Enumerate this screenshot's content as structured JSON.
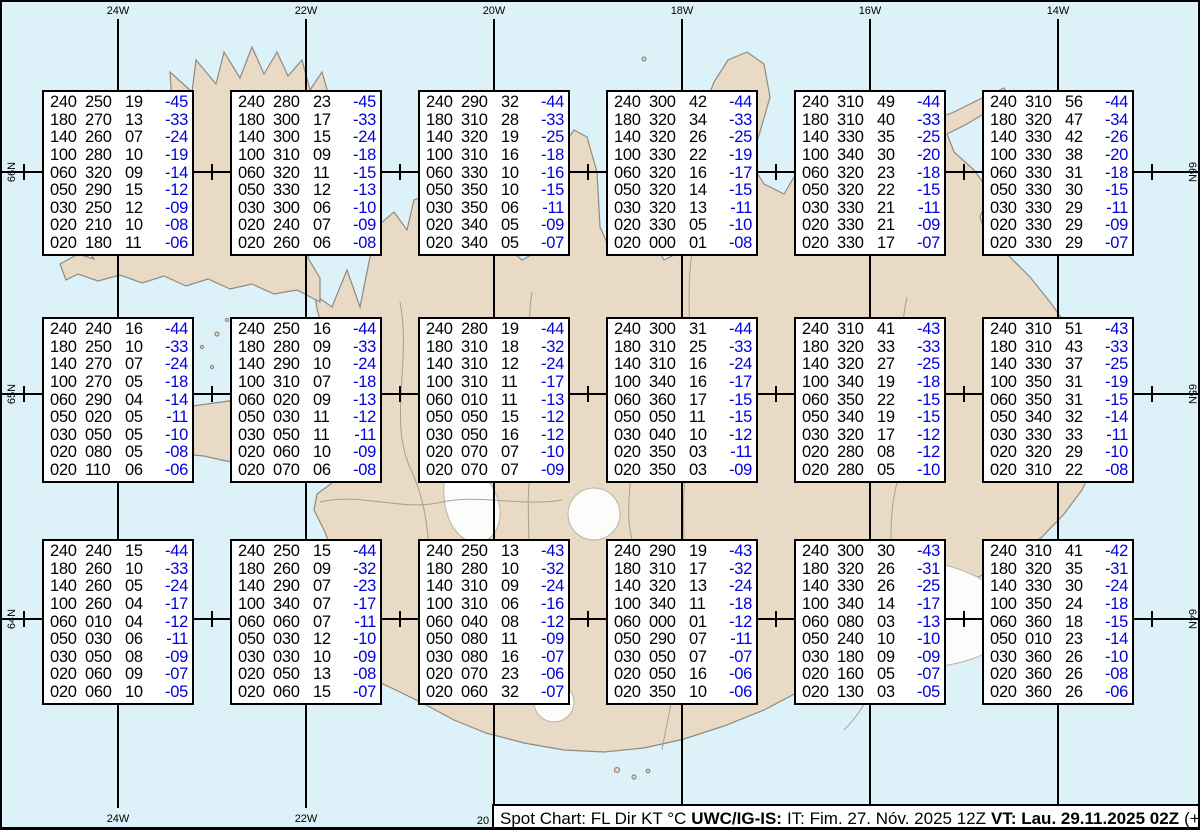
{
  "chart_data": {
    "type": "table",
    "title": "Spot Chart: FL Dir KT °C",
    "columns": [
      "FL",
      "Dir",
      "KT",
      "TempC"
    ],
    "grid_longitudes": [
      "24W",
      "22W",
      "20W",
      "18W",
      "16W",
      "14W"
    ],
    "grid_latitudes": [
      "66N",
      "65N",
      "64N"
    ],
    "points": [
      {
        "lat": "66N",
        "lon": "24W",
        "rows": [
          [
            "240",
            "250",
            "19",
            "-45"
          ],
          [
            "180",
            "270",
            "13",
            "-33"
          ],
          [
            "140",
            "260",
            "07",
            "-24"
          ],
          [
            "100",
            "280",
            "10",
            "-19"
          ],
          [
            "060",
            "320",
            "09",
            "-14"
          ],
          [
            "050",
            "290",
            "15",
            "-12"
          ],
          [
            "030",
            "250",
            "12",
            "-09"
          ],
          [
            "020",
            "210",
            "10",
            "-08"
          ],
          [
            "020",
            "180",
            "11",
            "-06"
          ]
        ]
      },
      {
        "lat": "66N",
        "lon": "22W",
        "rows": [
          [
            "240",
            "280",
            "23",
            "-45"
          ],
          [
            "180",
            "300",
            "17",
            "-33"
          ],
          [
            "140",
            "300",
            "15",
            "-24"
          ],
          [
            "100",
            "310",
            "09",
            "-18"
          ],
          [
            "060",
            "320",
            "11",
            "-15"
          ],
          [
            "050",
            "330",
            "12",
            "-13"
          ],
          [
            "030",
            "300",
            "06",
            "-10"
          ],
          [
            "020",
            "240",
            "07",
            "-09"
          ],
          [
            "020",
            "260",
            "06",
            "-08"
          ]
        ]
      },
      {
        "lat": "66N",
        "lon": "20W",
        "rows": [
          [
            "240",
            "290",
            "32",
            "-44"
          ],
          [
            "180",
            "310",
            "28",
            "-33"
          ],
          [
            "140",
            "320",
            "19",
            "-25"
          ],
          [
            "100",
            "310",
            "16",
            "-18"
          ],
          [
            "060",
            "330",
            "10",
            "-16"
          ],
          [
            "050",
            "350",
            "10",
            "-15"
          ],
          [
            "030",
            "350",
            "06",
            "-11"
          ],
          [
            "020",
            "340",
            "05",
            "-09"
          ],
          [
            "020",
            "340",
            "05",
            "-07"
          ]
        ]
      },
      {
        "lat": "66N",
        "lon": "18W",
        "rows": [
          [
            "240",
            "300",
            "42",
            "-44"
          ],
          [
            "180",
            "320",
            "34",
            "-33"
          ],
          [
            "140",
            "320",
            "26",
            "-25"
          ],
          [
            "100",
            "330",
            "22",
            "-19"
          ],
          [
            "060",
            "320",
            "16",
            "-17"
          ],
          [
            "050",
            "320",
            "14",
            "-15"
          ],
          [
            "030",
            "320",
            "13",
            "-11"
          ],
          [
            "020",
            "330",
            "05",
            "-10"
          ],
          [
            "020",
            "000",
            "01",
            "-08"
          ]
        ]
      },
      {
        "lat": "66N",
        "lon": "16W",
        "rows": [
          [
            "240",
            "310",
            "49",
            "-44"
          ],
          [
            "180",
            "310",
            "40",
            "-33"
          ],
          [
            "140",
            "330",
            "35",
            "-25"
          ],
          [
            "100",
            "340",
            "30",
            "-20"
          ],
          [
            "060",
            "320",
            "23",
            "-18"
          ],
          [
            "050",
            "320",
            "22",
            "-15"
          ],
          [
            "030",
            "330",
            "21",
            "-11"
          ],
          [
            "020",
            "330",
            "21",
            "-09"
          ],
          [
            "020",
            "330",
            "17",
            "-07"
          ]
        ]
      },
      {
        "lat": "66N",
        "lon": "14W",
        "rows": [
          [
            "240",
            "310",
            "56",
            "-44"
          ],
          [
            "180",
            "320",
            "47",
            "-34"
          ],
          [
            "140",
            "330",
            "42",
            "-26"
          ],
          [
            "100",
            "330",
            "38",
            "-20"
          ],
          [
            "060",
            "330",
            "31",
            "-18"
          ],
          [
            "050",
            "330",
            "30",
            "-15"
          ],
          [
            "030",
            "330",
            "29",
            "-11"
          ],
          [
            "020",
            "330",
            "29",
            "-09"
          ],
          [
            "020",
            "330",
            "29",
            "-07"
          ]
        ]
      },
      {
        "lat": "65N",
        "lon": "24W",
        "rows": [
          [
            "240",
            "240",
            "16",
            "-44"
          ],
          [
            "180",
            "250",
            "10",
            "-33"
          ],
          [
            "140",
            "270",
            "07",
            "-24"
          ],
          [
            "100",
            "270",
            "05",
            "-18"
          ],
          [
            "060",
            "290",
            "04",
            "-14"
          ],
          [
            "050",
            "020",
            "05",
            "-11"
          ],
          [
            "030",
            "050",
            "05",
            "-10"
          ],
          [
            "020",
            "080",
            "05",
            "-08"
          ],
          [
            "020",
            "110",
            "06",
            "-06"
          ]
        ]
      },
      {
        "lat": "65N",
        "lon": "22W",
        "rows": [
          [
            "240",
            "250",
            "16",
            "-44"
          ],
          [
            "180",
            "280",
            "09",
            "-33"
          ],
          [
            "140",
            "290",
            "10",
            "-24"
          ],
          [
            "100",
            "310",
            "07",
            "-18"
          ],
          [
            "060",
            "020",
            "09",
            "-13"
          ],
          [
            "050",
            "030",
            "11",
            "-12"
          ],
          [
            "030",
            "050",
            "11",
            "-11"
          ],
          [
            "020",
            "060",
            "10",
            "-09"
          ],
          [
            "020",
            "070",
            "06",
            "-08"
          ]
        ]
      },
      {
        "lat": "65N",
        "lon": "20W",
        "rows": [
          [
            "240",
            "280",
            "19",
            "-44"
          ],
          [
            "180",
            "310",
            "18",
            "-32"
          ],
          [
            "140",
            "310",
            "12",
            "-24"
          ],
          [
            "100",
            "310",
            "11",
            "-17"
          ],
          [
            "060",
            "010",
            "11",
            "-13"
          ],
          [
            "050",
            "050",
            "15",
            "-12"
          ],
          [
            "030",
            "050",
            "16",
            "-12"
          ],
          [
            "020",
            "070",
            "07",
            "-10"
          ],
          [
            "020",
            "070",
            "07",
            "-09"
          ]
        ]
      },
      {
        "lat": "65N",
        "lon": "18W",
        "rows": [
          [
            "240",
            "300",
            "31",
            "-44"
          ],
          [
            "180",
            "310",
            "25",
            "-33"
          ],
          [
            "140",
            "310",
            "16",
            "-24"
          ],
          [
            "100",
            "340",
            "16",
            "-17"
          ],
          [
            "060",
            "360",
            "17",
            "-15"
          ],
          [
            "050",
            "050",
            "11",
            "-15"
          ],
          [
            "030",
            "040",
            "10",
            "-12"
          ],
          [
            "020",
            "350",
            "03",
            "-11"
          ],
          [
            "020",
            "350",
            "03",
            "-09"
          ]
        ]
      },
      {
        "lat": "65N",
        "lon": "16W",
        "rows": [
          [
            "240",
            "310",
            "41",
            "-43"
          ],
          [
            "180",
            "320",
            "33",
            "-33"
          ],
          [
            "140",
            "320",
            "27",
            "-25"
          ],
          [
            "100",
            "340",
            "19",
            "-18"
          ],
          [
            "060",
            "350",
            "22",
            "-15"
          ],
          [
            "050",
            "340",
            "19",
            "-15"
          ],
          [
            "030",
            "320",
            "17",
            "-12"
          ],
          [
            "020",
            "280",
            "08",
            "-12"
          ],
          [
            "020",
            "280",
            "05",
            "-10"
          ]
        ]
      },
      {
        "lat": "65N",
        "lon": "14W",
        "rows": [
          [
            "240",
            "310",
            "51",
            "-43"
          ],
          [
            "180",
            "310",
            "43",
            "-33"
          ],
          [
            "140",
            "330",
            "37",
            "-25"
          ],
          [
            "100",
            "350",
            "31",
            "-19"
          ],
          [
            "060",
            "350",
            "31",
            "-15"
          ],
          [
            "050",
            "340",
            "32",
            "-14"
          ],
          [
            "030",
            "330",
            "33",
            "-11"
          ],
          [
            "020",
            "320",
            "29",
            "-10"
          ],
          [
            "020",
            "310",
            "22",
            "-08"
          ]
        ]
      },
      {
        "lat": "64N",
        "lon": "24W",
        "rows": [
          [
            "240",
            "240",
            "15",
            "-44"
          ],
          [
            "180",
            "260",
            "10",
            "-33"
          ],
          [
            "140",
            "260",
            "05",
            "-24"
          ],
          [
            "100",
            "260",
            "04",
            "-17"
          ],
          [
            "060",
            "010",
            "04",
            "-12"
          ],
          [
            "050",
            "030",
            "06",
            "-11"
          ],
          [
            "030",
            "050",
            "08",
            "-09"
          ],
          [
            "020",
            "060",
            "09",
            "-07"
          ],
          [
            "020",
            "060",
            "10",
            "-05"
          ]
        ]
      },
      {
        "lat": "64N",
        "lon": "22W",
        "rows": [
          [
            "240",
            "250",
            "15",
            "-44"
          ],
          [
            "180",
            "260",
            "09",
            "-32"
          ],
          [
            "140",
            "290",
            "07",
            "-23"
          ],
          [
            "100",
            "340",
            "07",
            "-17"
          ],
          [
            "060",
            "060",
            "07",
            "-11"
          ],
          [
            "050",
            "030",
            "12",
            "-10"
          ],
          [
            "030",
            "030",
            "10",
            "-09"
          ],
          [
            "020",
            "050",
            "13",
            "-08"
          ],
          [
            "020",
            "060",
            "15",
            "-07"
          ]
        ]
      },
      {
        "lat": "64N",
        "lon": "20W",
        "rows": [
          [
            "240",
            "250",
            "13",
            "-43"
          ],
          [
            "180",
            "280",
            "10",
            "-32"
          ],
          [
            "140",
            "310",
            "09",
            "-24"
          ],
          [
            "100",
            "310",
            "06",
            "-16"
          ],
          [
            "060",
            "040",
            "08",
            "-12"
          ],
          [
            "050",
            "080",
            "11",
            "-09"
          ],
          [
            "030",
            "080",
            "16",
            "-07"
          ],
          [
            "020",
            "070",
            "23",
            "-06"
          ],
          [
            "020",
            "060",
            "32",
            "-07"
          ]
        ]
      },
      {
        "lat": "64N",
        "lon": "18W",
        "rows": [
          [
            "240",
            "290",
            "19",
            "-43"
          ],
          [
            "180",
            "310",
            "17",
            "-32"
          ],
          [
            "140",
            "320",
            "13",
            "-24"
          ],
          [
            "100",
            "340",
            "11",
            "-18"
          ],
          [
            "060",
            "000",
            "01",
            "-12"
          ],
          [
            "050",
            "290",
            "07",
            "-11"
          ],
          [
            "030",
            "050",
            "07",
            "-07"
          ],
          [
            "020",
            "050",
            "16",
            "-06"
          ],
          [
            "020",
            "350",
            "10",
            "-06"
          ]
        ]
      },
      {
        "lat": "64N",
        "lon": "16W",
        "rows": [
          [
            "240",
            "300",
            "30",
            "-43"
          ],
          [
            "180",
            "320",
            "26",
            "-31"
          ],
          [
            "140",
            "330",
            "26",
            "-25"
          ],
          [
            "100",
            "340",
            "14",
            "-17"
          ],
          [
            "060",
            "080",
            "03",
            "-13"
          ],
          [
            "050",
            "240",
            "10",
            "-10"
          ],
          [
            "030",
            "180",
            "09",
            "-09"
          ],
          [
            "020",
            "160",
            "05",
            "-07"
          ],
          [
            "020",
            "130",
            "03",
            "-05"
          ]
        ]
      },
      {
        "lat": "64N",
        "lon": "14W",
        "rows": [
          [
            "240",
            "310",
            "41",
            "-42"
          ],
          [
            "180",
            "320",
            "35",
            "-31"
          ],
          [
            "140",
            "330",
            "30",
            "-24"
          ],
          [
            "100",
            "350",
            "24",
            "-18"
          ],
          [
            "060",
            "360",
            "18",
            "-15"
          ],
          [
            "050",
            "010",
            "23",
            "-14"
          ],
          [
            "030",
            "360",
            "26",
            "-10"
          ],
          [
            "020",
            "360",
            "26",
            "-08"
          ],
          [
            "020",
            "360",
            "26",
            "-06"
          ]
        ]
      }
    ]
  },
  "map": {
    "top_lon_labels": [
      "24W",
      "22W",
      "20W",
      "18W",
      "16W",
      "14W"
    ],
    "bottom_lon_labels": [
      "24W",
      "22W",
      "20"
    ],
    "left_lat_labels": [
      "66N",
      "65N",
      "64N"
    ],
    "right_lat_labels": [
      "66N",
      "65N",
      "64N"
    ],
    "colors": {
      "ocean": "#ddf2f8",
      "land": "#e9dac6",
      "coast": "#8f8a80",
      "glacier": "#fcfcfa",
      "grid": "#000000",
      "temp_text": "#0000dd"
    }
  },
  "status_bar": {
    "label_prefix": "Spot Chart: FL Dir KT °C",
    "org_bold": "UWC/IG-IS:",
    "issue_text": "IT: Fim. 27. Nóv. 2025 12Z",
    "valid_bold": "VT: Lau. 29.11.2025 02Z",
    "offset_text": "(+38 h)"
  }
}
